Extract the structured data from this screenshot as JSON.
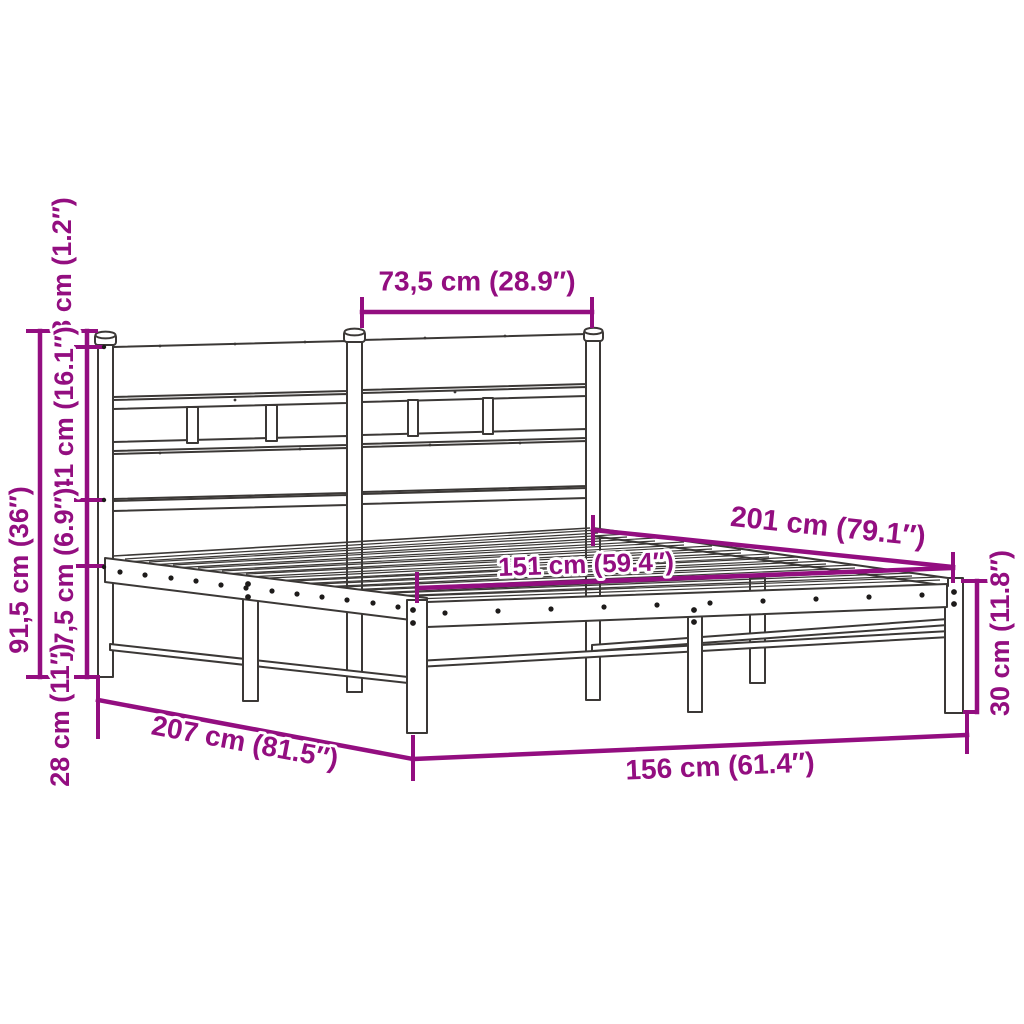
{
  "diagram": {
    "subject": "Metal bed frame with headboard - dimension drawing",
    "accent_color": "#930E80",
    "outline_color": "#3B3836",
    "dims": {
      "headboard_half_width": "73,5 cm (28.9″)",
      "post_cap_offset": "3 cm (1.2″)",
      "headboard_panel_height": "41 cm (16.1″)",
      "headboard_to_base_gap": "17,5 cm (6.9″)",
      "underbed_clearance": "28 cm (11″)",
      "headboard_total_height": "91,5 cm (36″)",
      "frame_length": "201 cm (79.1″)",
      "slat_surface_width": "151 cm (59.4″)",
      "platform_height": "30 cm (11.8″)",
      "total_length": "207 cm (81.5″)",
      "total_width": "156 cm (61.4″)"
    }
  }
}
